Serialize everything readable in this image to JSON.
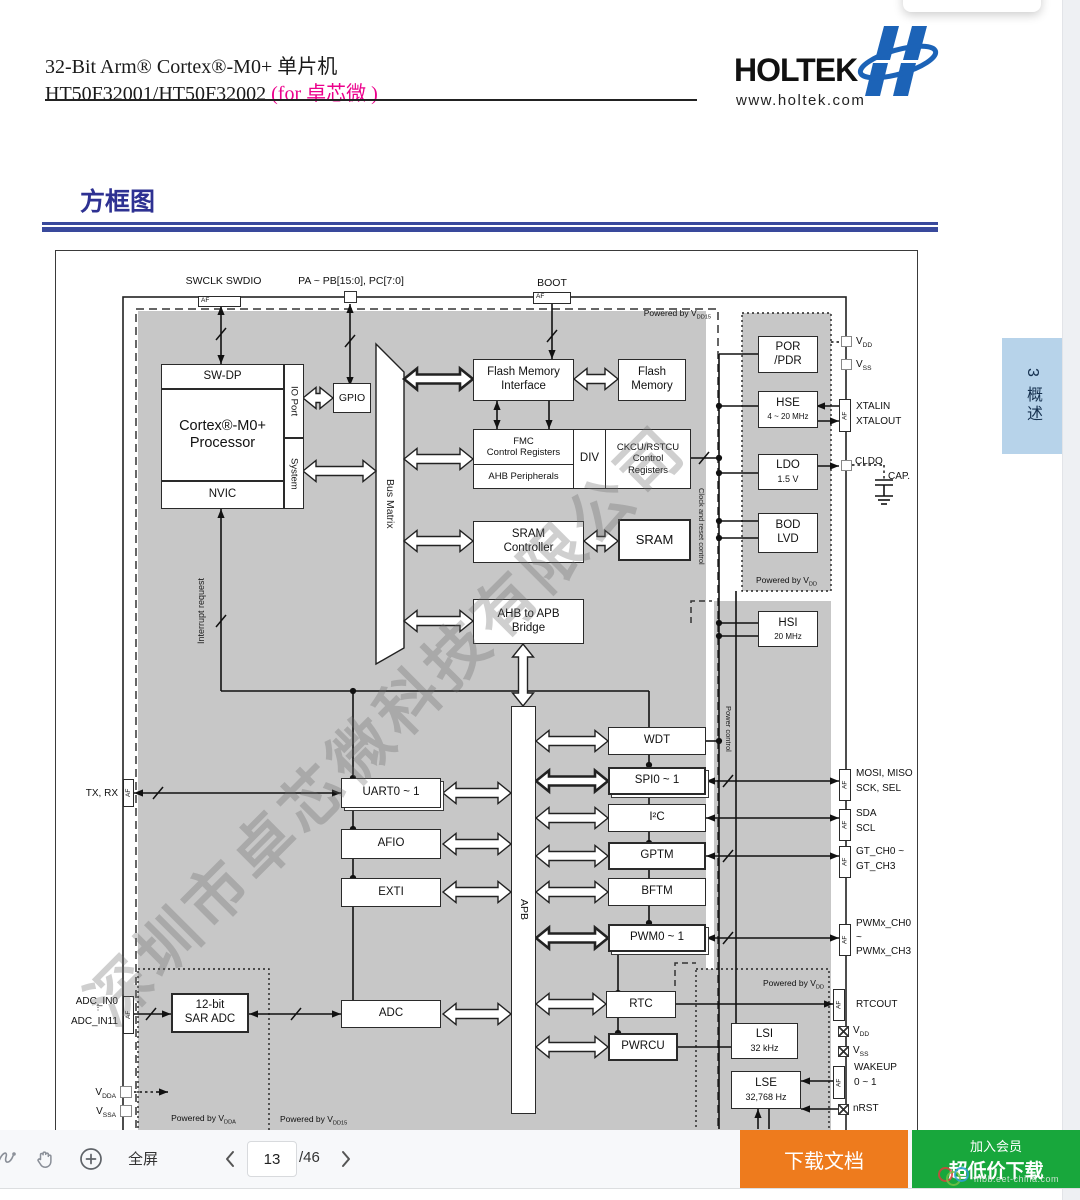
{
  "header": {
    "title_line1": "32-Bit Arm® Cortex®-M0+ 单片机",
    "title_line2_black": "HT50F32001/HT50F32002 ",
    "title_line2_pink": "(for 卓芯微 )",
    "logo_text": "HOLTEK",
    "logo_url": "www.holtek.com"
  },
  "section": {
    "heading": "方框图"
  },
  "side_tab": {
    "num": "3",
    "label": "概述"
  },
  "watermark": {
    "text": "深圳市卓芯微科技有限公司",
    "site": "mbb.eet-china.com"
  },
  "toolbar": {
    "fullscreen_label": "全屏",
    "page_current": "13",
    "page_total": "/46",
    "download_label": "下载文档",
    "join_label": "加入会员",
    "cheap_label": "超低价下载"
  },
  "colors": {
    "heading_blue": "#2e3192",
    "rule_blue": "#39499c",
    "orange": "#ee7b1d",
    "green": "#18a73c",
    "tab_blue": "#b7d3ea",
    "diagram_gray": "#c7c7c7",
    "pink": "#ec008c"
  },
  "diagram": {
    "blocks": {
      "swdp": "SW-DP",
      "cortex": "Cortex®-M0+\nProcessor",
      "nvic": "NVIC",
      "ioport": "IO Port",
      "system": "System",
      "gpio": "GPIO",
      "busmatrix": "Bus Matrix",
      "fmi": "Flash Memory\nInterface",
      "flash": "Flash\nMemory",
      "fmc": "FMC\nControl Registers",
      "ahbp": "AHB Peripherals",
      "divb": "DIV",
      "ckcu": "CKCU/RSTCU\nControl\nRegisters",
      "sramc": "SRAM\nController",
      "sram": "SRAM",
      "bridge": "AHB to APB\nBridge",
      "apb": "APB",
      "wdt": "WDT",
      "spi": "SPI0 ~ 1",
      "i2c": "I²C",
      "gptm": "GPTM",
      "bftm": "BFTM",
      "pwm": "PWM0 ~ 1",
      "rtc": "RTC",
      "pwrcu": "PWRCU",
      "uart": "UART0 ~ 1",
      "afio": "AFIO",
      "exti": "EXTI",
      "adc": "ADC",
      "saradc": "12-bit\nSAR ADC",
      "por": "POR\n/PDR",
      "hse": "HSE",
      "hse_sub": "4 ~ 20 MHz",
      "ldo": "LDO",
      "ldo_sub": "1.5 V",
      "bod": "BOD\nLVD",
      "hsi": "HSI",
      "hsi_sub": "20 MHz",
      "lsi": "LSI",
      "lsi_sub": "32 kHz",
      "lse": "LSE",
      "lse_sub": "32,768 Hz"
    },
    "pins": {
      "af": "AF",
      "swclk": "SWCLK SWDIO",
      "papb": "PA ~ PB[15:0], PC[7:0]",
      "boot": "BOOT",
      "txrx": "TX, RX",
      "adcin0": "ADC_IN0",
      "adc_dots": "⋮",
      "adcin11": "ADC_IN11",
      "vdda": {
        "m": "V",
        "s": "DDA"
      },
      "vssa": {
        "m": "V",
        "s": "SSA"
      },
      "vdd": {
        "m": "V",
        "s": "DD"
      },
      "vss": {
        "m": "V",
        "s": "SS"
      },
      "xtalin": "XTALIN",
      "xtalout": "XTALOUT",
      "cldo": "CLDO",
      "cap": "CAP.",
      "mosi": "MOSI, MISO",
      "sck": "SCK, SEL",
      "sda": "SDA",
      "scl": "SCL",
      "gt0": "GT_CH0 ~",
      "gt3": "GT_CH3",
      "pwmx0": "PWMx_CH0",
      "pwmx_t": "~",
      "pwmx3": "PWMx_CH3",
      "rtcout": "RTCOUT",
      "wakeup": "WAKEUP",
      "wakeup_r": "0 ~ 1",
      "nrst": "nRST"
    },
    "labels": {
      "pow_vdd15": {
        "m": "Powered by V",
        "s": "DD15"
      },
      "pow_vdd": {
        "m": "Powered by V",
        "s": "DD"
      },
      "pow_vdda": {
        "m": "Powered by V",
        "s": "DDA"
      },
      "interrupt": "Interrupt request",
      "clock": "Clock and reset control",
      "power": "Power control"
    }
  }
}
